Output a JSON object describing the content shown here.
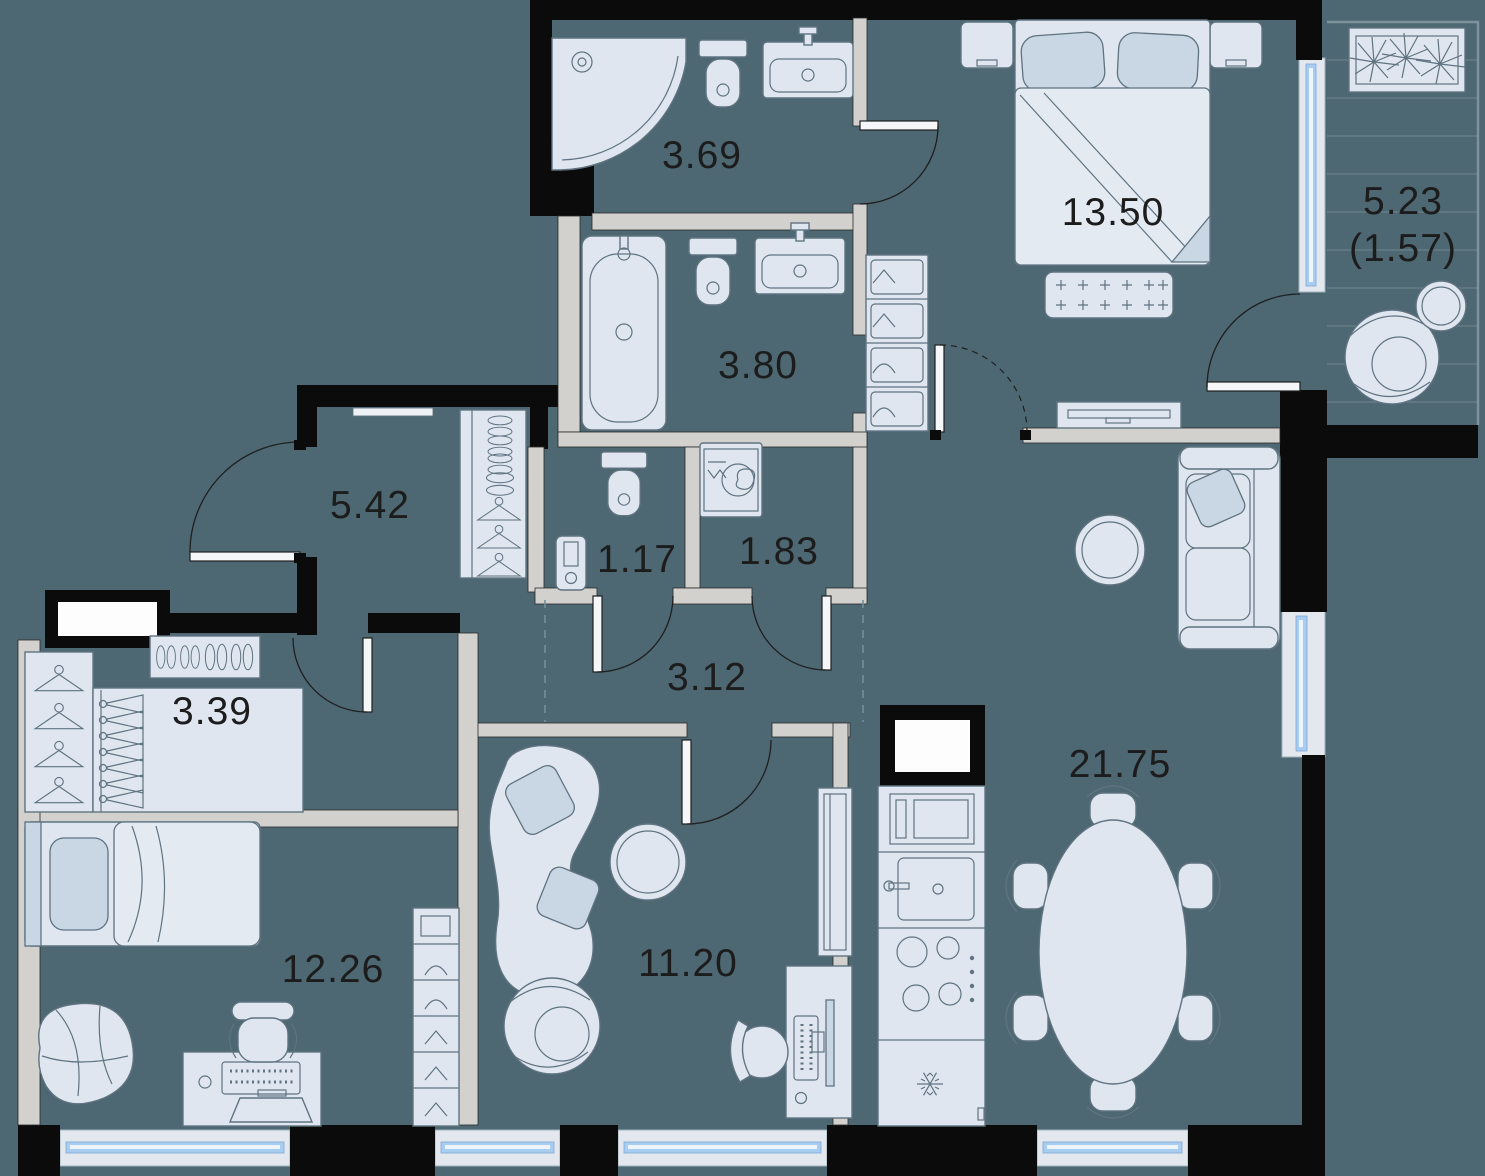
{
  "plan_type": "apartment-floor-plan",
  "colors": {
    "floor": "#4d6872",
    "walls": "#0b0b0b",
    "partitions": "#d2d1cd",
    "furniture": "#dfe6f0",
    "glass": "#a9ccf1",
    "label_text": "#1c1c1c"
  },
  "rooms": [
    {
      "name": "bathroom-shower",
      "area": "3.69"
    },
    {
      "name": "bathroom-main",
      "area": "3.80"
    },
    {
      "name": "bedroom",
      "area": "13.50"
    },
    {
      "name": "balcony",
      "area": "5.23",
      "area_secondary": "(1.57)"
    },
    {
      "name": "hallway",
      "area": "5.42"
    },
    {
      "name": "wc",
      "area": "1.17"
    },
    {
      "name": "laundry",
      "area": "1.83"
    },
    {
      "name": "corridor",
      "area": "3.12"
    },
    {
      "name": "closet",
      "area": "3.39"
    },
    {
      "name": "kids-room",
      "area": "12.26"
    },
    {
      "name": "study",
      "area": "11.20"
    },
    {
      "name": "living-kitchen",
      "area": "21.75"
    }
  ]
}
